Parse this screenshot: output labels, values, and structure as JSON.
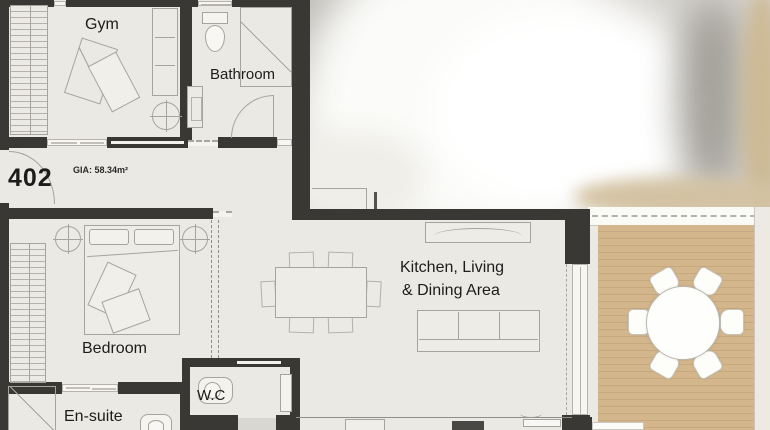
{
  "plan": {
    "unit_number": "402",
    "gia_label": "GIA: 58.34m²",
    "rooms": {
      "gym": "Gym",
      "bathroom": "Bathroom",
      "bedroom": "Bedroom",
      "ensuite": "En-suite",
      "wc": "W.C",
      "kitchen_line1": "Kitchen, Living",
      "kitchen_line2": "& Dining Area"
    },
    "colors": {
      "wall": "#3a3834",
      "floor": "#eae9e3",
      "balcony_deck": "#d4b68c",
      "balcony_deck_stripe": "#c8a97e",
      "furniture_line": "#a6a49c",
      "label_text": "#1c1c1c"
    }
  }
}
